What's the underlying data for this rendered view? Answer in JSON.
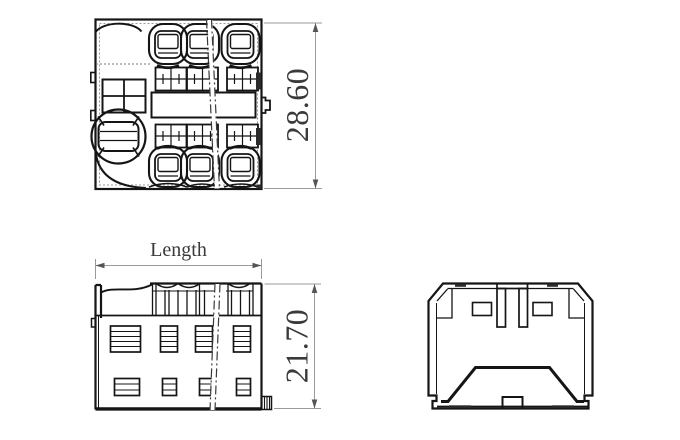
{
  "drawing": {
    "dimensions": {
      "overall_height": "28.60",
      "length_label": "Length",
      "body_height": "21.70"
    },
    "colors": {
      "background": "#ffffff",
      "object_line": "#151515",
      "dimension_line": "#9a9a9a",
      "dimension_text": "#3a3a3a"
    }
  }
}
